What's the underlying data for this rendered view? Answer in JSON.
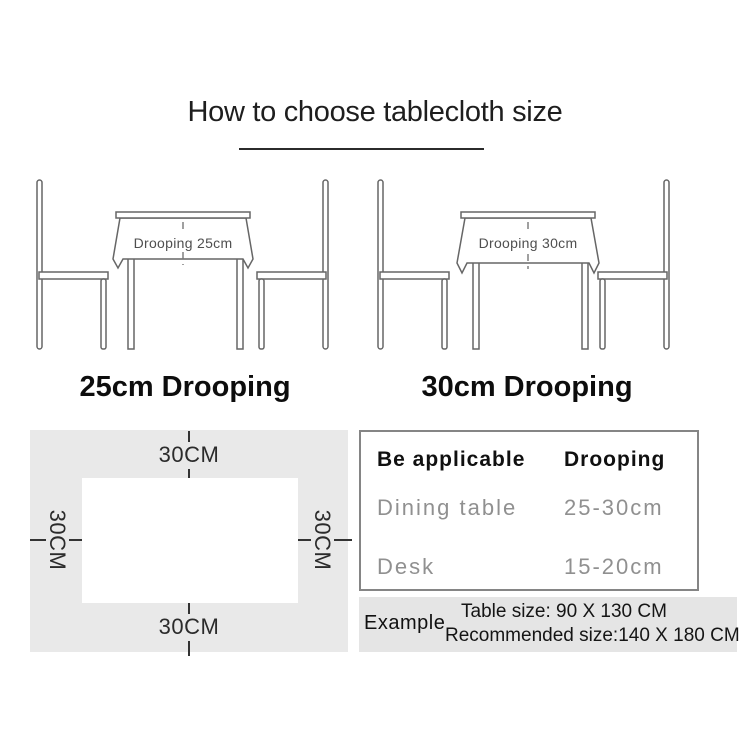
{
  "title": "How to choose tablecloth size",
  "diagram_left": {
    "drooping_text": "Drooping 25cm",
    "caption": "25cm Drooping"
  },
  "diagram_right": {
    "drooping_text": "Drooping 30cm",
    "caption": "30cm Drooping"
  },
  "size_diagram": {
    "top": "30CM",
    "bottom": "30CM",
    "left": "30CM",
    "right": "30CM"
  },
  "spec_table": {
    "header": {
      "col1": "Be applicable",
      "col2": "Drooping"
    },
    "rows": [
      {
        "col1": "Dining table",
        "col2": "25-30cm"
      },
      {
        "col1": "Desk",
        "col2": "15-20cm"
      }
    ]
  },
  "example": {
    "label": "Example",
    "line1": "Table size:  90 X 130 CM",
    "line2": "Recommended size:140 X 180 CM"
  },
  "colors": {
    "panel_gray": "#e9e9e9",
    "strip_gray": "#e5e5e5",
    "line_art": "#666666",
    "muted_text": "#909090",
    "ink": "#101010"
  }
}
